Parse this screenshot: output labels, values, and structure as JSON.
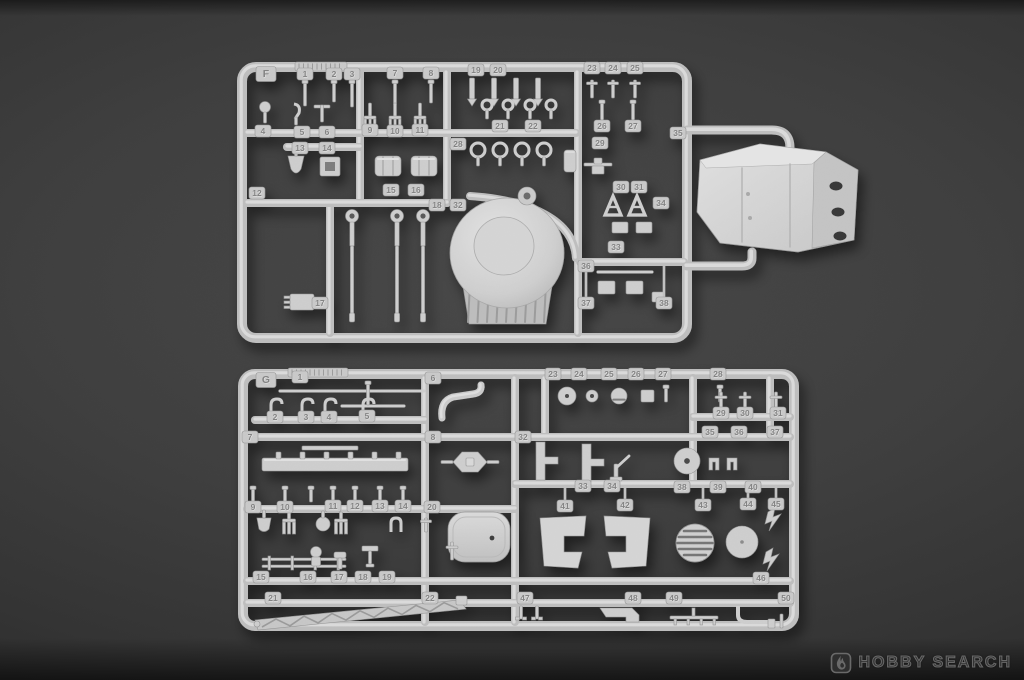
{
  "watermark": {
    "brand": "HOBBY SEARCH",
    "icon": "flame-icon"
  },
  "sprues": [
    {
      "name": "sprue-f",
      "letter": "F",
      "part_numbers": [
        "1",
        "2",
        "3",
        "4",
        "5",
        "6",
        "7",
        "8",
        "9",
        "10",
        "11",
        "12",
        "13",
        "14",
        "15",
        "16",
        "17",
        "18",
        "19",
        "20",
        "21",
        "22",
        "23",
        "24",
        "25",
        "26",
        "27",
        "28",
        "29",
        "30",
        "31",
        "32",
        "33",
        "34",
        "35",
        "36",
        "37",
        "38"
      ]
    },
    {
      "name": "sprue-g",
      "letter": "G",
      "part_numbers": [
        "1",
        "2",
        "3",
        "4",
        "5",
        "6",
        "7",
        "8",
        "9",
        "10",
        "11",
        "12",
        "13",
        "14",
        "15",
        "16",
        "17",
        "18",
        "19",
        "20",
        "21",
        "22",
        "23",
        "24",
        "25",
        "26",
        "27",
        "28",
        "29",
        "30",
        "31",
        "32",
        "33",
        "34",
        "35",
        "36",
        "37",
        "38",
        "39",
        "40",
        "41",
        "42",
        "43",
        "44",
        "45",
        "46",
        "47",
        "48",
        "49",
        "50"
      ]
    }
  ]
}
